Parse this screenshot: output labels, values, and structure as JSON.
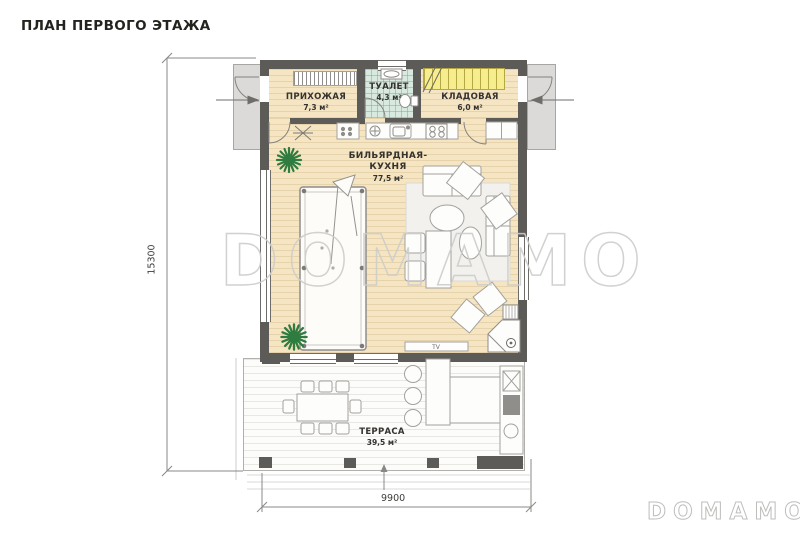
{
  "title": "ПЛАН ПЕРВОГО ЭТАЖА",
  "watermark": "DOMAMO",
  "brand_logo": "DOMAMO",
  "dimensions": {
    "vertical": "15300",
    "horizontal": "9900"
  },
  "rooms": {
    "hallway": {
      "name": "ПРИХОЖАЯ",
      "area": "7,3 м²"
    },
    "toilet": {
      "name": "ТУАЛЕТ",
      "area": "4,3 м²"
    },
    "storage": {
      "name": "КЛАДОВАЯ",
      "area": "6,0 м²"
    },
    "billiard_kitchen": {
      "name_line1": "БИЛЬЯРДНАЯ-",
      "name_line2": "КУХНЯ",
      "area": "77,5 м²"
    },
    "terrace": {
      "name": "ТЕРРАСА",
      "area": "39,5 м²"
    }
  },
  "furniture_labels": {
    "tv": "TV"
  },
  "colors": {
    "floor": "#f5e5c2",
    "wall": "#5d5b57",
    "toilet_floor": "#d8eadf",
    "stairs": "#f6ee8e",
    "porch": "#dbdad8",
    "terrace_floor": "#fcfcfa",
    "plant": "#2e7c40",
    "watermark": "#cdcdcb"
  }
}
